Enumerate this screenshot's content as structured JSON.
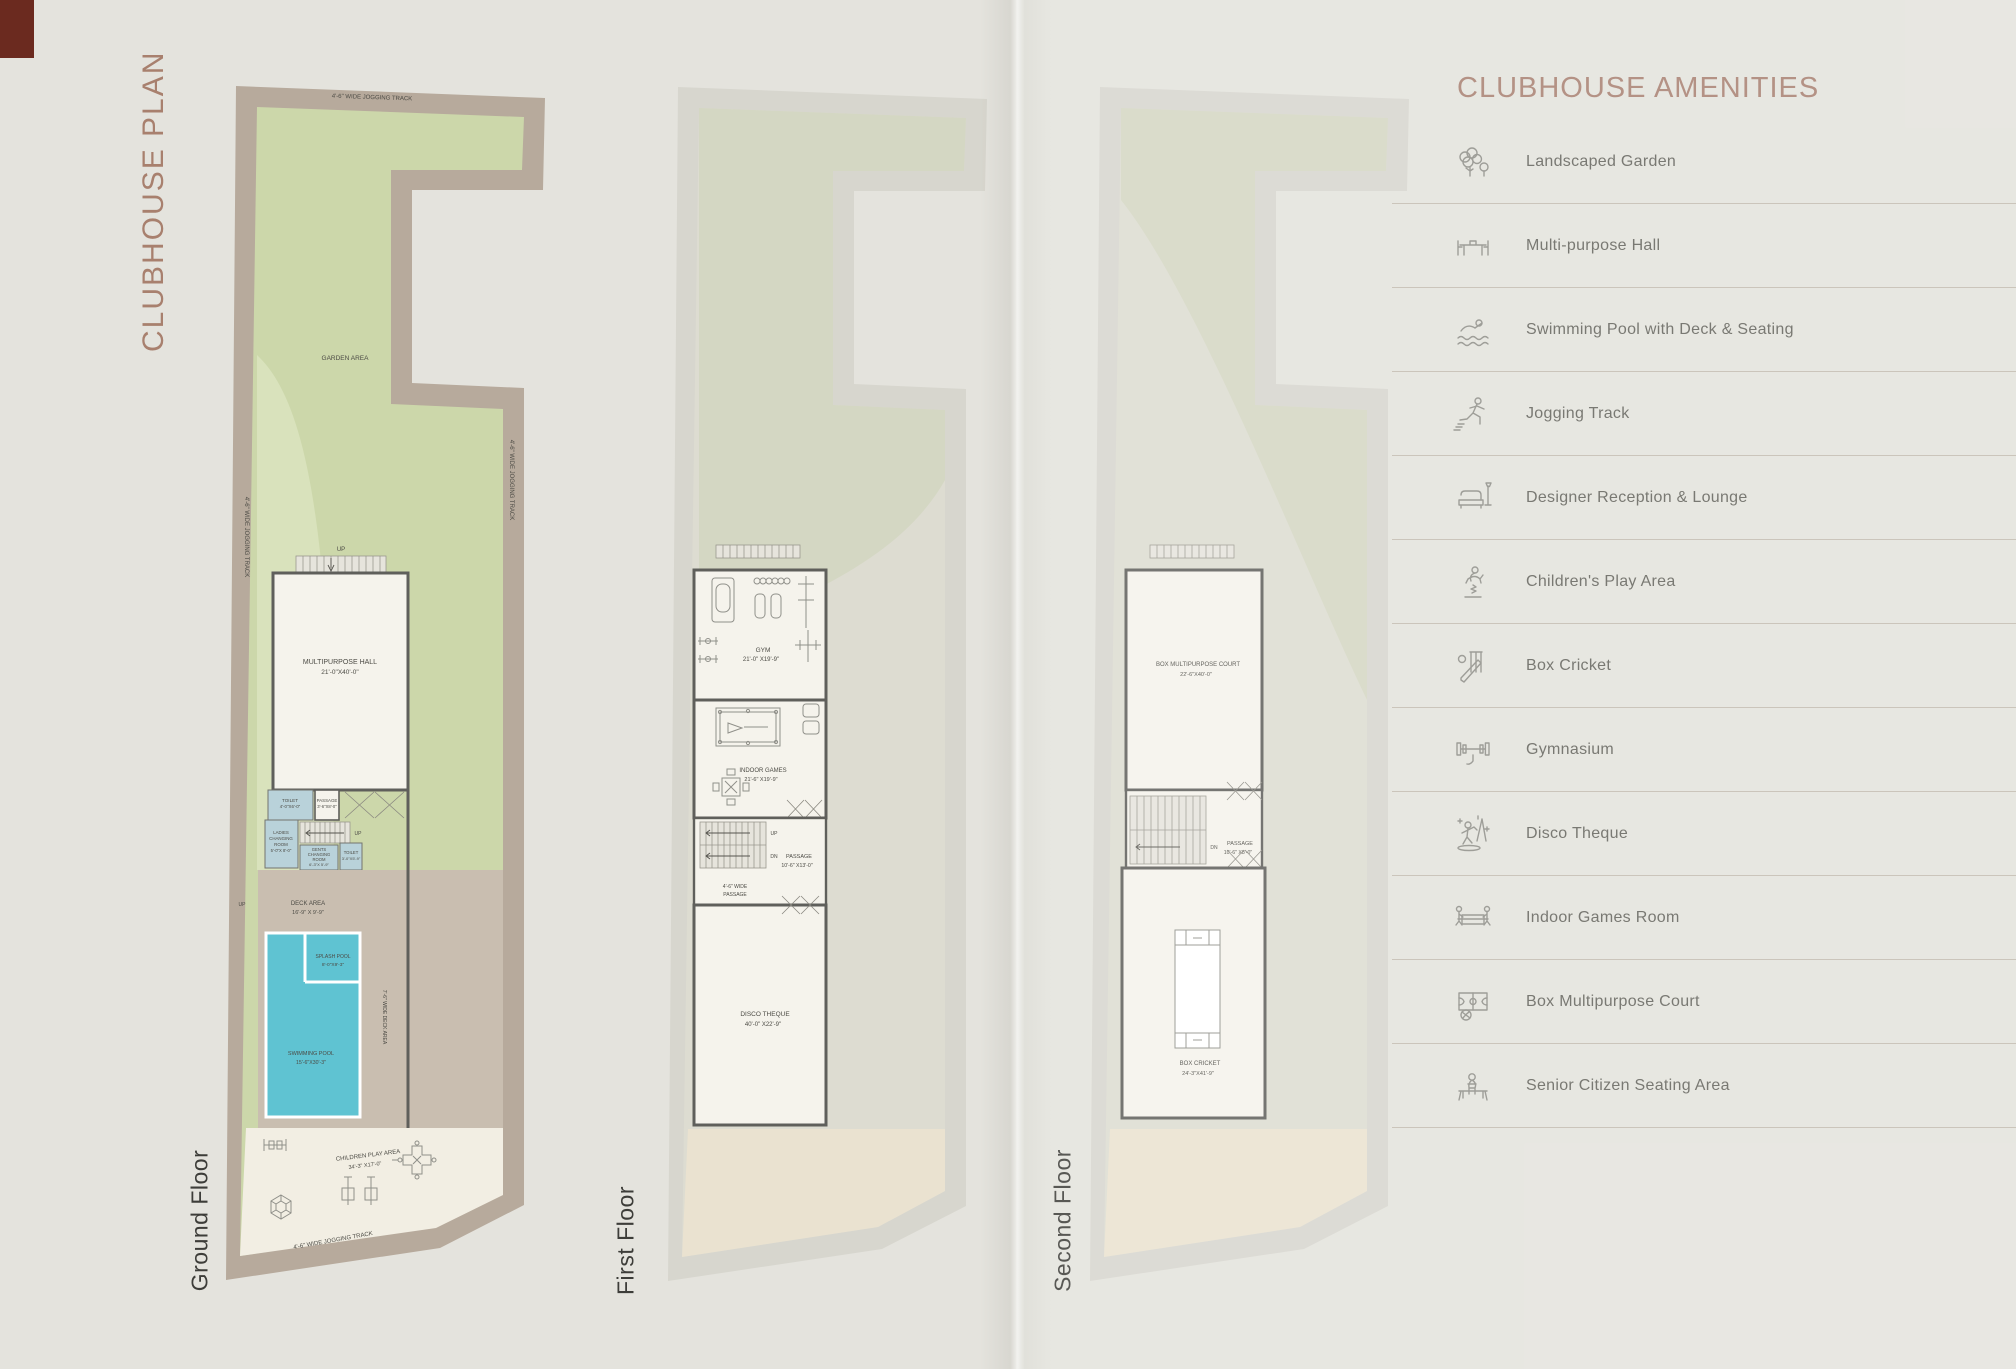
{
  "page": {
    "side_title": "CLUBHOUSE PLAN"
  },
  "ground": {
    "floor_label": "Ground Floor",
    "track": "4'-6\" WIDE JOGGING TRACK",
    "garden_area": "GARDEN AREA",
    "up": "UP",
    "hall_name": "MULTIPURPOSE HALL",
    "hall_dim": "21'-0\"X40'-0\"",
    "toilet1_name": "TOILET",
    "toilet1_dim": "4'-0\"X6'-0\"",
    "passage_name": "PASSAGE",
    "passage_dim": "3'-6\"X8'-0\"",
    "ladies_l1": "LADIES",
    "ladies_l2": "CHANGING",
    "ladies_l3": "ROOM",
    "ladies_l4": "5'-0\"X 8'-0\"",
    "gents_l1": "GENTS",
    "gents_l2": "CHANGING",
    "gents_l3": "ROOM",
    "gents_l4": "6'-3\"X 5'-9\"",
    "toilet2_name": "TOILET",
    "toilet2_dim": "3'-0\"X5'-9\"",
    "deck_name": "DECK AREA",
    "deck_dim": "16'-9\" X 9'-9\"",
    "splash_name": "SPLASH POOL",
    "splash_dim": "8'-0\"X9'-3\"",
    "swim_name": "SWIMMING POOL",
    "swim_dim": "15'-6\"X30'-3\"",
    "deck_side": "7'-6\" WIDE DECK AREA",
    "children_name": "CHILDREN PLAY AREA",
    "children_dim": "34'-3\" X17'-0\""
  },
  "first": {
    "floor_label": "First Floor",
    "gym_name": "GYM",
    "gym_dim": "21'-0\" X19'-9\"",
    "games_name": "INDOOR GAMES",
    "games_dim": "21'-6\" X19'-9\"",
    "up": "UP",
    "dn": "DN",
    "passage_name": "PASSAGE",
    "passage_dim": "10'-6\" X13'-0\"",
    "wide_l1": "4'-6\" WIDE",
    "wide_l2": "PASSAGE",
    "disco_name": "DISCO THEQUE",
    "disco_dim": "40'-0\" X22'-9\""
  },
  "second": {
    "floor_label": "Second Floor",
    "court_name": "BOX MULTIPURPOSE COURT",
    "court_dim": "22'-6\"X40'-0\"",
    "passage_name": "PASSAGE",
    "passage_dim": "10'-6\" X8'-0\"",
    "dn": "DN",
    "cricket_name": "BOX CRICKET",
    "cricket_dim": "24'-3\"X41'-9\""
  },
  "amenities": {
    "title": "CLUBHOUSE AMENITIES",
    "items": [
      {
        "icon": "landscaped-garden-icon",
        "label": "Landscaped Garden"
      },
      {
        "icon": "multipurpose-hall-icon",
        "label": "Multi-purpose Hall"
      },
      {
        "icon": "swimming-pool-icon",
        "label": "Swimming Pool with Deck & Seating"
      },
      {
        "icon": "jogging-track-icon",
        "label": "Jogging Track"
      },
      {
        "icon": "reception-lounge-icon",
        "label": "Designer Reception & Lounge"
      },
      {
        "icon": "children-play-icon",
        "label": "Children's Play Area"
      },
      {
        "icon": "box-cricket-icon",
        "label": "Box Cricket"
      },
      {
        "icon": "gymnasium-icon",
        "label": "Gymnasium"
      },
      {
        "icon": "disco-theque-icon",
        "label": "Disco Theque"
      },
      {
        "icon": "indoor-games-icon",
        "label": "Indoor Games Room"
      },
      {
        "icon": "box-court-icon",
        "label": "Box Multipurpose Court"
      },
      {
        "icon": "senior-seating-icon",
        "label": "Senior Citizen Seating Area"
      }
    ]
  }
}
